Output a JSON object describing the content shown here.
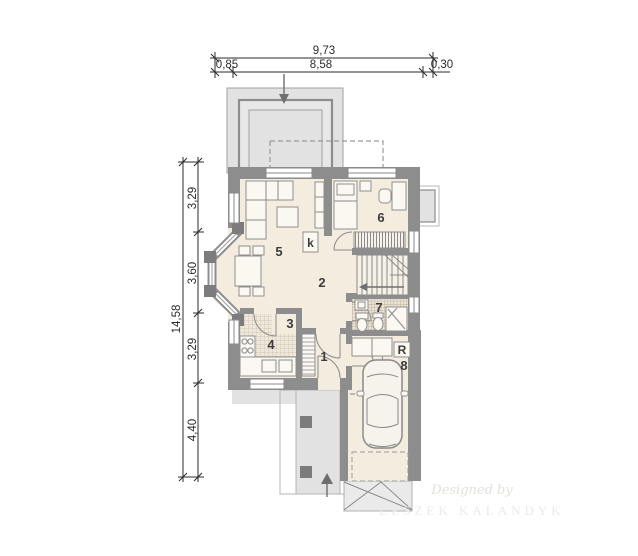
{
  "dimensions": {
    "top": {
      "total": "9,73",
      "segments": [
        "0,85",
        "8,58",
        "0,30"
      ]
    },
    "left": {
      "total": "14,58",
      "segments": [
        "3,29",
        "3,60",
        "3,29",
        "4,40"
      ]
    }
  },
  "room_numbers": [
    "1",
    "2",
    "3",
    "4",
    "5",
    "6",
    "7",
    "8"
  ],
  "annotations": {
    "closet": "k",
    "boiler": "R"
  },
  "watermark": {
    "line1": "Designed by",
    "line2": "LESZEK KALANDYK"
  },
  "colors": {
    "wall": "#8d8d8d",
    "floor": "#f3ecdf",
    "paving": "#e2e2e2",
    "line": "#8a8a8a",
    "dimension_text": "#2b2b2b"
  }
}
